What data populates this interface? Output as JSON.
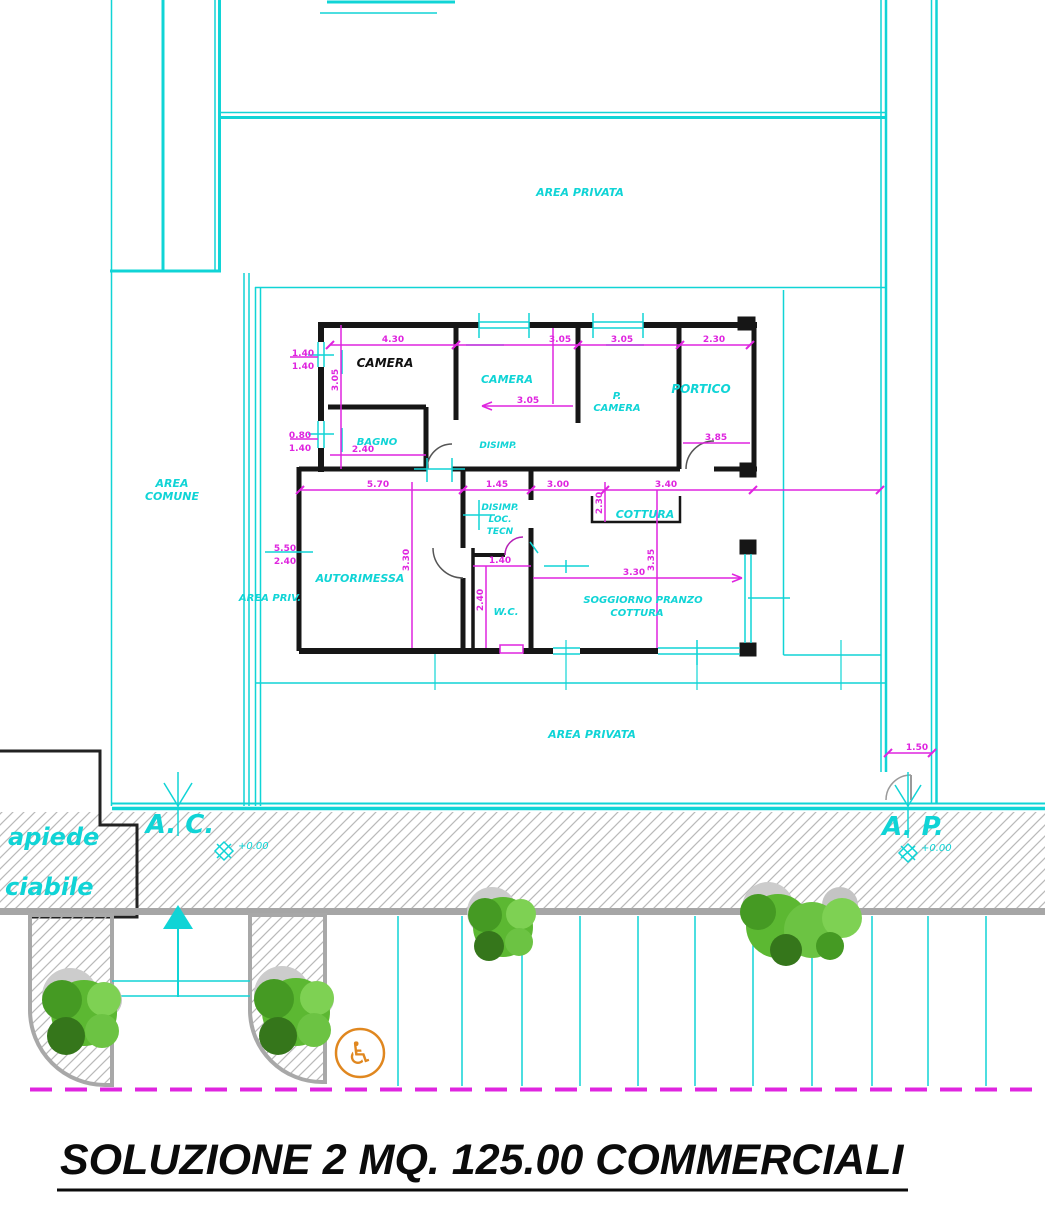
{
  "title": "SOLUZIONE 2 MQ. 125.00 COMMERCIALI",
  "colors": {
    "cyan": "#10d4d6",
    "magenta": "#df25df",
    "wall_black": "#161616",
    "hatch_gray": "#b9b9b9",
    "curb_gray": "#a6a6a6",
    "tree_green": "#5cb832",
    "orange": "#e0871f"
  },
  "site": {
    "area_privata_top": "AREA PRIVATA",
    "area_privata_bottom": "AREA PRIVATA",
    "area_comune": [
      "AREA",
      "COMUNE"
    ],
    "area_priv": "AREA PRIV.",
    "sidewalk_fragment": "apiede",
    "driveway_fragment": "ciabile",
    "access_left": "A. C.",
    "access_right": "A. P.",
    "elevation_left": "+0.00",
    "elevation_right": "+0.00"
  },
  "rooms": {
    "camera_black": "CAMERA",
    "camera_cyan": "CAMERA",
    "p_camera": [
      "P.",
      "CAMERA"
    ],
    "portico": "PORTICO",
    "bagno": "BAGNO",
    "disimp": "DISIMP.",
    "loc_tecn": [
      "DISIMP.",
      "LOC.",
      "TECN"
    ],
    "wc": "W.C.",
    "autorimessa": "AUTORIMESSA",
    "cottura": "COTTURA",
    "soggiorno": [
      "SOGGIORNO PRANZO",
      "COTTURA"
    ]
  },
  "dims": {
    "win1": [
      "1.40",
      "1.40"
    ],
    "win2": [
      "0.80",
      "1.40"
    ],
    "garage_door": [
      "5.50",
      "2.40"
    ],
    "top": [
      "4.30",
      "3.05",
      "3.05",
      "2.30"
    ],
    "camera2_width": "3.05",
    "portico_depth": "3.85",
    "bagno_width": "2.40",
    "garage_width": "5.70",
    "corridor": "1.45",
    "cottura_width": "3.00",
    "cottura_right": "3.40",
    "cottura_depth": "2.30",
    "wc_width": "1.40",
    "wc_depth": "2.40",
    "soggiorno_width": "3.30",
    "soggiorno_depth": "3.35",
    "camera_depth": "3.05",
    "autorimessa_depth": "3.30",
    "gate_width": "1.50"
  },
  "icons": {
    "wheelchair": "♿"
  }
}
